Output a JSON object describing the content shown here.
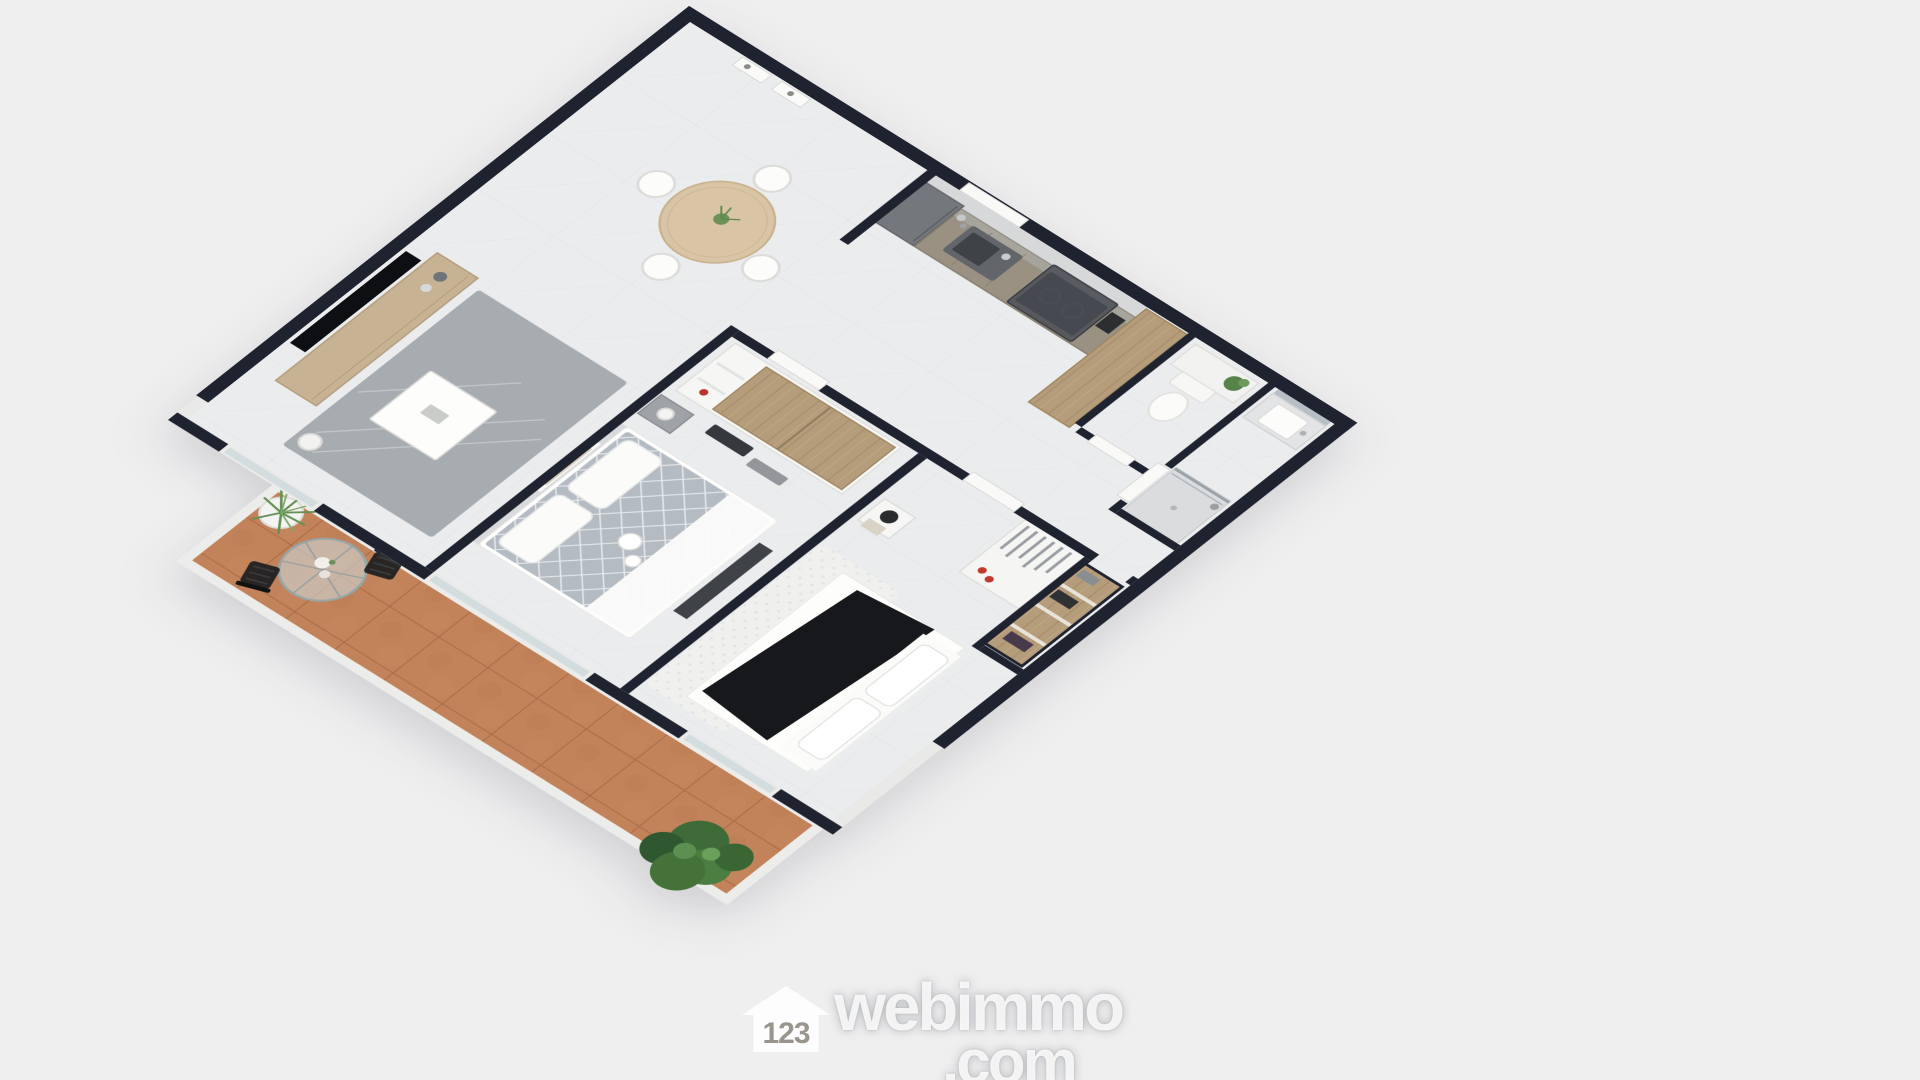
{
  "scene": {
    "type": "3d-floor-plan",
    "view": "axonometric top-down render, rotated about 32 degrees",
    "apartment": {
      "rooms": [
        {
          "name": "living-dining-room",
          "furniture": [
            "wall-mounted-tv",
            "tv-sideboard",
            "decor-vases",
            "area-rug",
            "coffee-table",
            "floor-lamp",
            "round-wood-dining-table",
            "white-dining-chair x4",
            "table-plant",
            "framed-botanical-art x2"
          ]
        },
        {
          "name": "kitchen",
          "furniture": [
            "marble-backsplash",
            "tall-fridge-unit",
            "counter-run",
            "double-sink",
            "faucet",
            "induction-cooktop",
            "range-hood",
            "coffee-machine",
            "counter-bottles",
            "tall-wood-cabinet"
          ]
        },
        {
          "name": "hallway",
          "furniture": [
            "white-interior-door x4",
            "entry-door"
          ]
        },
        {
          "name": "wc",
          "furniture": [
            "toilet",
            "low-shelf",
            "potted-plant"
          ]
        },
        {
          "name": "bathroom",
          "furniture": [
            "wall-mirror",
            "vanity-counter",
            "washbasin",
            "faucet",
            "walk-in-shower",
            "glass-screen"
          ]
        },
        {
          "name": "dressing-closet",
          "furniture": [
            "wood-shelving-unit",
            "stored-items"
          ]
        },
        {
          "name": "bedroom-1",
          "furniture": [
            "double-bed-grey-diamond-duvet",
            "pillows x2",
            "white-throw",
            "breakfast-tray",
            "headboard",
            "sliding-wood-door-wardrobe",
            "nightstand",
            "table-lamp",
            "dark-bench",
            "door-mats",
            "wall-art"
          ]
        },
        {
          "name": "bedroom-2",
          "furniture": [
            "double-bed-white-linen",
            "black-throw-blanket",
            "pillows x2",
            "open-wardrobe",
            "hanging-clothes",
            "red-shoes",
            "nightstand",
            "dark-table-lamp",
            "magazine",
            "fluffy-white-rug"
          ]
        },
        {
          "name": "terrace",
          "furniture": [
            "terracotta-tile-floor",
            "round-glass-bistro-table",
            "flower-vase",
            "black-bistro-chair x2",
            "white-potted-grass",
            "large-leafy-plant"
          ]
        }
      ]
    }
  },
  "watermark": {
    "logo_icon": "house-icon",
    "brand_prefix": "123",
    "brand": "webimmo",
    "tld": ".com",
    "style": "translucent-white"
  },
  "colors": {
    "background": "#efeff0",
    "wall_dark": "#1f2330",
    "wall_white": "#ebebe9",
    "floor_marble": "#ebecee",
    "terrace_terracotta": "#c2825a",
    "wood": "#b59c7a",
    "wood_light": "#d9c5a5",
    "kitchen_cabinet": "#9a9183",
    "appliance_grey": "#4d5158",
    "appliance_black": "#121316",
    "rug_grey": "#a7acb1",
    "bed_grey": "#b5bbc2",
    "blanket_black": "#17181b",
    "furniture_white": "#fbfbfa",
    "plant_green": "#4c7d41",
    "accent_red": "#c0392b",
    "glass_blue": "#cdd7d8",
    "watermark_white": "rgba(255,255,255,0.85)"
  }
}
